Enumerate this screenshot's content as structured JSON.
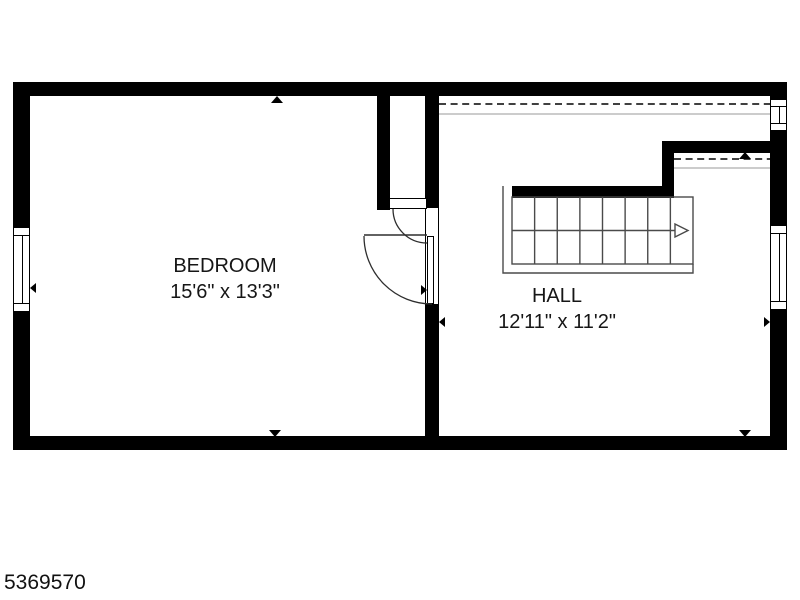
{
  "page": {
    "background_color": "#ffffff",
    "listing_id": "5369570"
  },
  "floorplan": {
    "wall_color": "#000000",
    "thin_line_color": "#4a4a4a",
    "rooms": [
      {
        "name": "BEDROOM",
        "dimensions": "15'6\" x 13'3\""
      },
      {
        "name": "HALL",
        "dimensions": "12'11\" x 11'2\""
      }
    ],
    "features": {
      "stairs": {
        "steps": 8,
        "direction": "right"
      },
      "windows_count": 3,
      "doors_count": 2,
      "dimension_markers_count": 8
    }
  }
}
